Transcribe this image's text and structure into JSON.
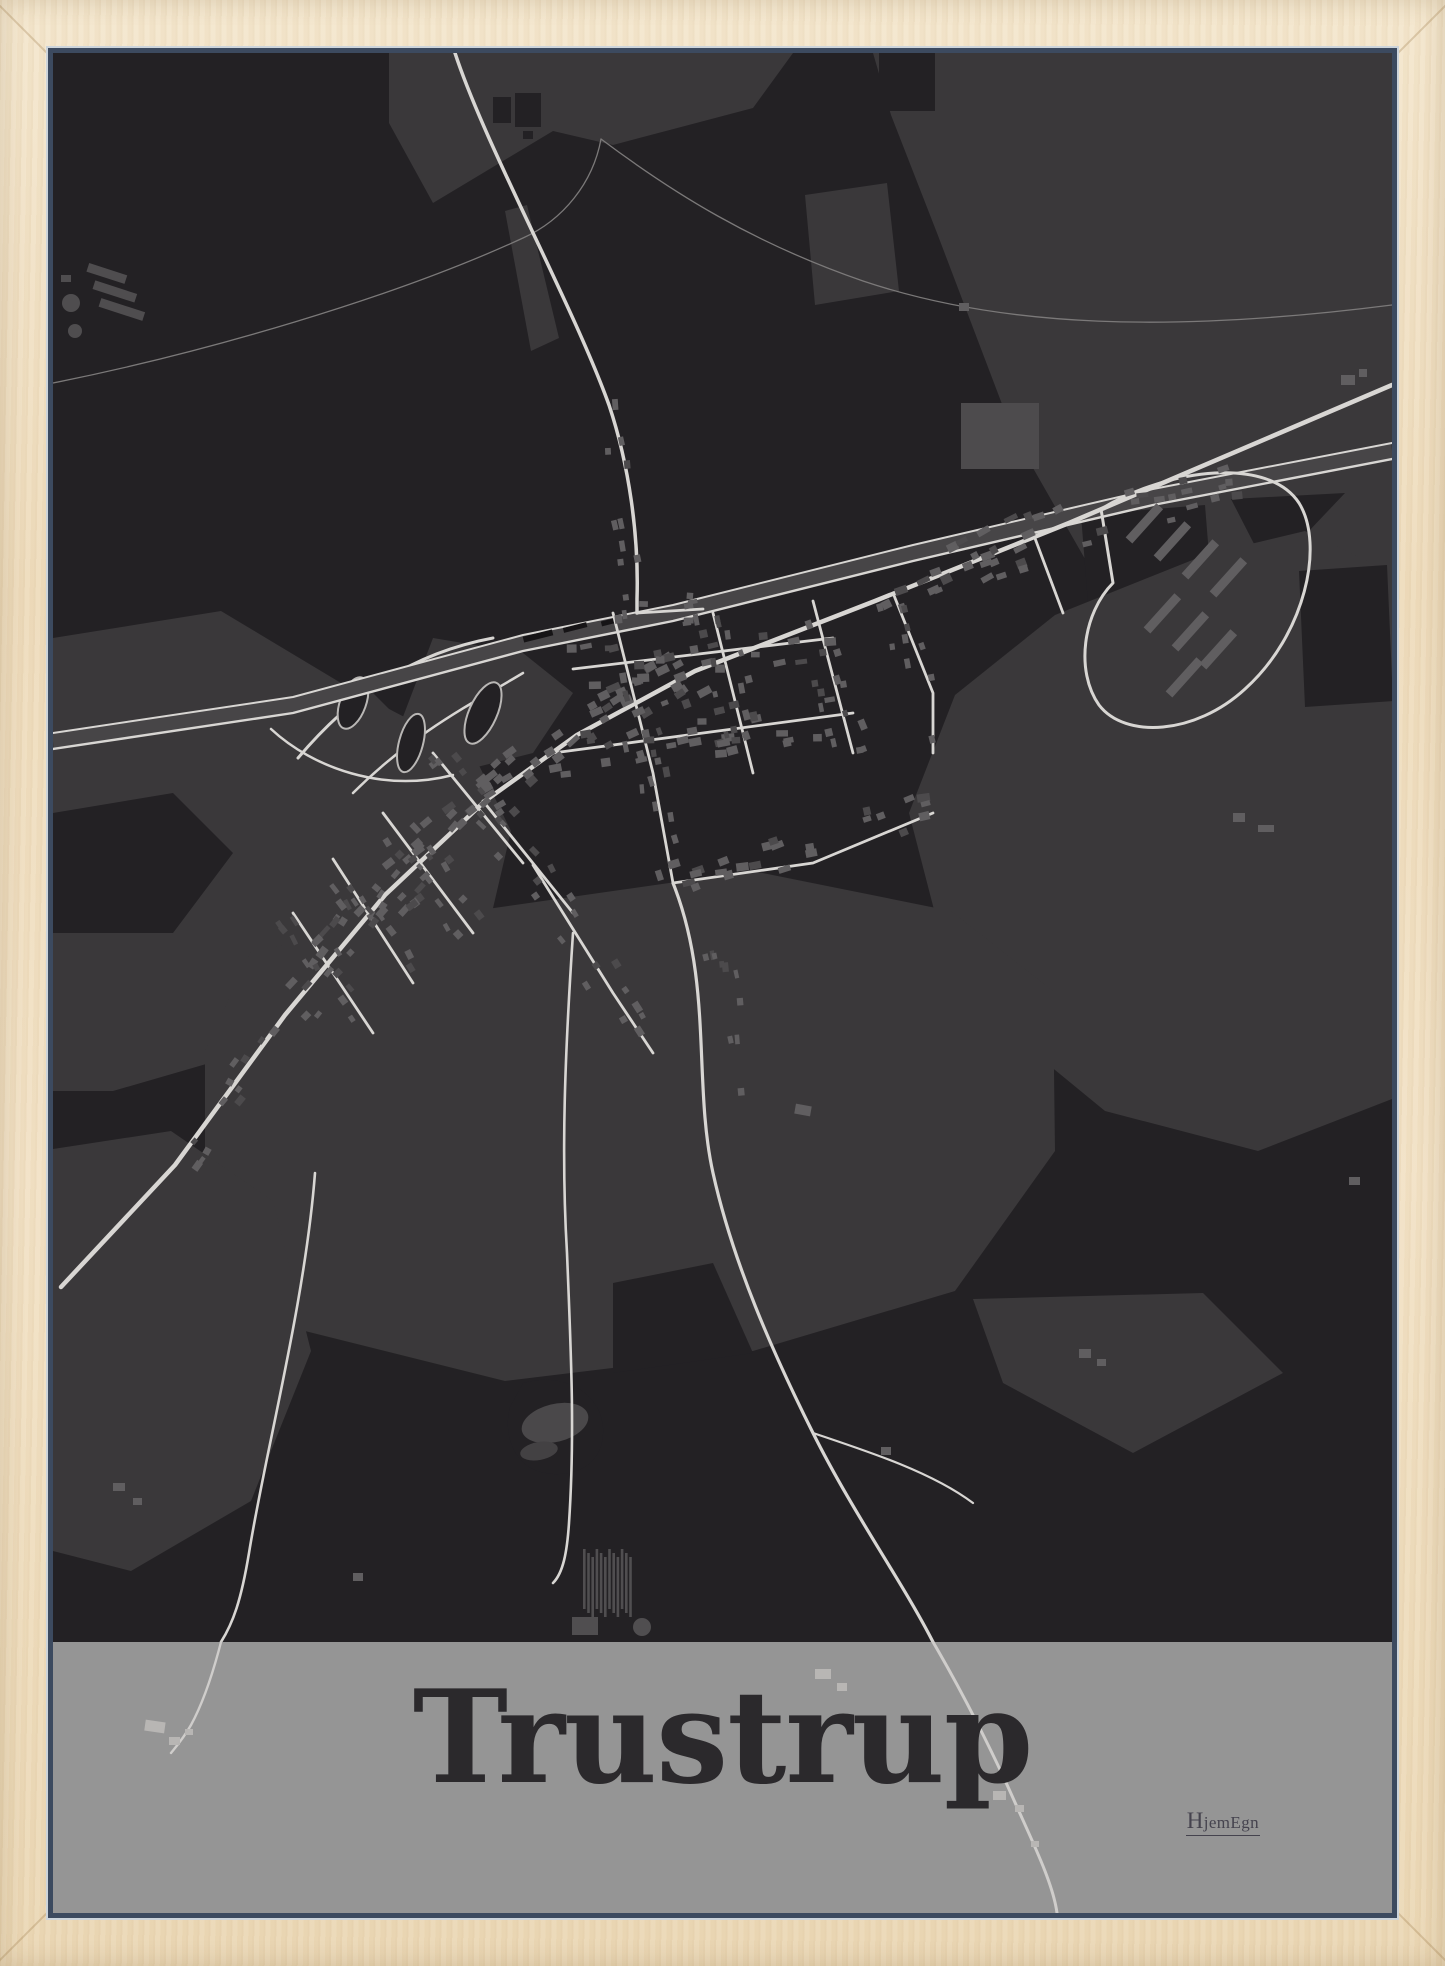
{
  "poster": {
    "title": "Trustrup",
    "brand": "HjemEgn"
  },
  "colors": {
    "frame_wood": "#efdec1",
    "lining_light": "#ccd4db",
    "lining_dark": "#3c4a5f",
    "map_bg": "#232124",
    "map_field": "#3a383a",
    "map_field_dark": "#2b292b",
    "bld": "#605e60",
    "bld_dark": "#4c4a4c",
    "road": "#d8d6d3",
    "road_thin": "#7b7979",
    "corridor": "#474547",
    "band_bg": "#959595",
    "band_road": "#cfcdcb",
    "band_bld": "#b8b6b4",
    "title_color": "#2b292c",
    "brand_color": "#45434e"
  }
}
